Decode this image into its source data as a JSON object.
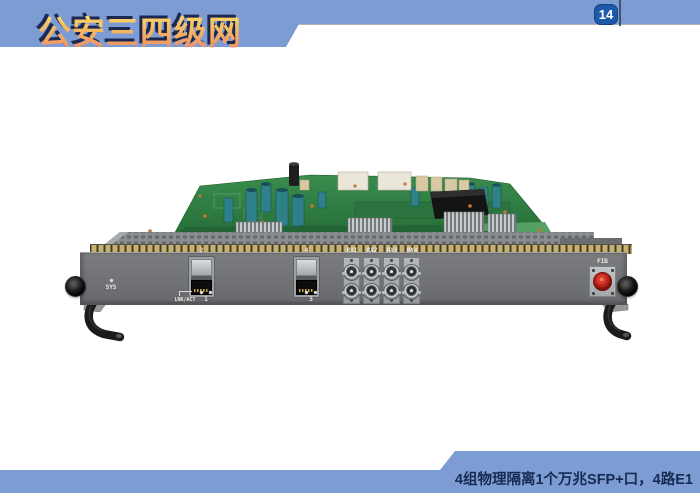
{
  "slide": {
    "header": {
      "title": "公安三四级网",
      "page_number": "14"
    },
    "footer": {
      "caption": "4组物理隔离1个万兆SFP+口，4路E1"
    },
    "colors": {
      "banner_blue": "#7D9CD4",
      "badge_blue": "#1D5AAB",
      "caption_navy": "#172A52",
      "title_gold": "#F7D75C",
      "title_orange": "#ED8B66",
      "title_shadow_navy": "#1D2850",
      "pcb_green": "#2E7C41",
      "faceplate_gray": "#6F7174",
      "fiber_red": "#C23024"
    }
  },
  "device": {
    "sys_label": "SYS",
    "sfp_ports": [
      {
        "top_label": "2",
        "bottom_label": "1",
        "status_label": "LNK/ACT"
      },
      {
        "top_label": "4",
        "bottom_label": "3"
      }
    ],
    "bnc_labels": [
      "RX1",
      "RX2",
      "RX3",
      "RX4"
    ],
    "fiber_label": "FIB"
  }
}
